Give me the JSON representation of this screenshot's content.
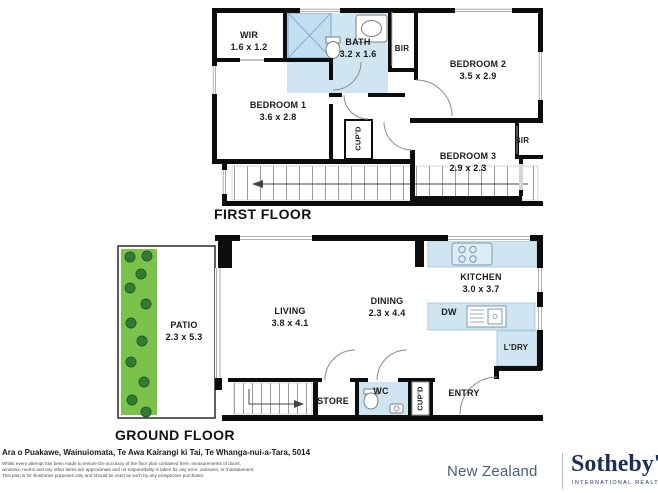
{
  "colors": {
    "wall": "#0d0d0d",
    "wet_area_blue": "#cfe6f2",
    "patio_green": "#7cc24a",
    "plant_green": "#2f7d33",
    "brand_navy": "#1c2f5c",
    "brand_gray_blue": "#4d5c77"
  },
  "first_floor": {
    "label": "FIRST FLOOR",
    "rooms": {
      "wir": {
        "name": "WIR",
        "dims": "1.6 x 1.2"
      },
      "bath": {
        "name": "BATH",
        "dims": "3.2 x 1.6"
      },
      "bir_top": {
        "name": "BIR"
      },
      "bedroom2": {
        "name": "BEDROOM 2",
        "dims": "3.5 x 2.9"
      },
      "bedroom1": {
        "name": "BEDROOM 1",
        "dims": "3.6 x 2.8"
      },
      "cupboard": {
        "name": "CUP'D"
      },
      "bedroom3": {
        "name": "BEDROOM 3",
        "dims": "2.9 x 2.3"
      },
      "bir_side": {
        "name": "BIR"
      }
    }
  },
  "ground_floor": {
    "label": "GROUND FLOOR",
    "rooms": {
      "patio": {
        "name": "PATIO",
        "dims": "2.3 x 5.3"
      },
      "living": {
        "name": "LIVING",
        "dims": "3.8 x 4.1"
      },
      "dining": {
        "name": "DINING",
        "dims": "2.3 x 4.4"
      },
      "kitchen": {
        "name": "KITCHEN",
        "dims": "3.0 x 3.7"
      },
      "dishwasher": {
        "name": "DW"
      },
      "laundry": {
        "name": "L'DRY"
      },
      "entry": {
        "name": "ENTRY"
      },
      "store": {
        "name": "STORE"
      },
      "wc": {
        "name": "WC"
      },
      "cupboard": {
        "name": "CUP'D"
      }
    }
  },
  "footer": {
    "address": "Ara o Puakawe, Wainuiomata, Te Awa Kairangi ki Tai, Te Whanga-nui-a-Tara, 5014",
    "disclaimer_line1": "Whilst every attempt has been made to ensure the accuracy of the floor plan contained here, measurements of doors,",
    "disclaimer_line2": "windows, rooms and any other items are approximate and no responsibility is taken for any error, omission, or misstatement.",
    "disclaimer_line3": "This plan is for illustrative purposes only and should be used as such by any prospective purchaser.",
    "brand_region": "New Zealand",
    "brand_name": "Sotheby's",
    "brand_sub": "INTERNATIONAL REALTY"
  }
}
